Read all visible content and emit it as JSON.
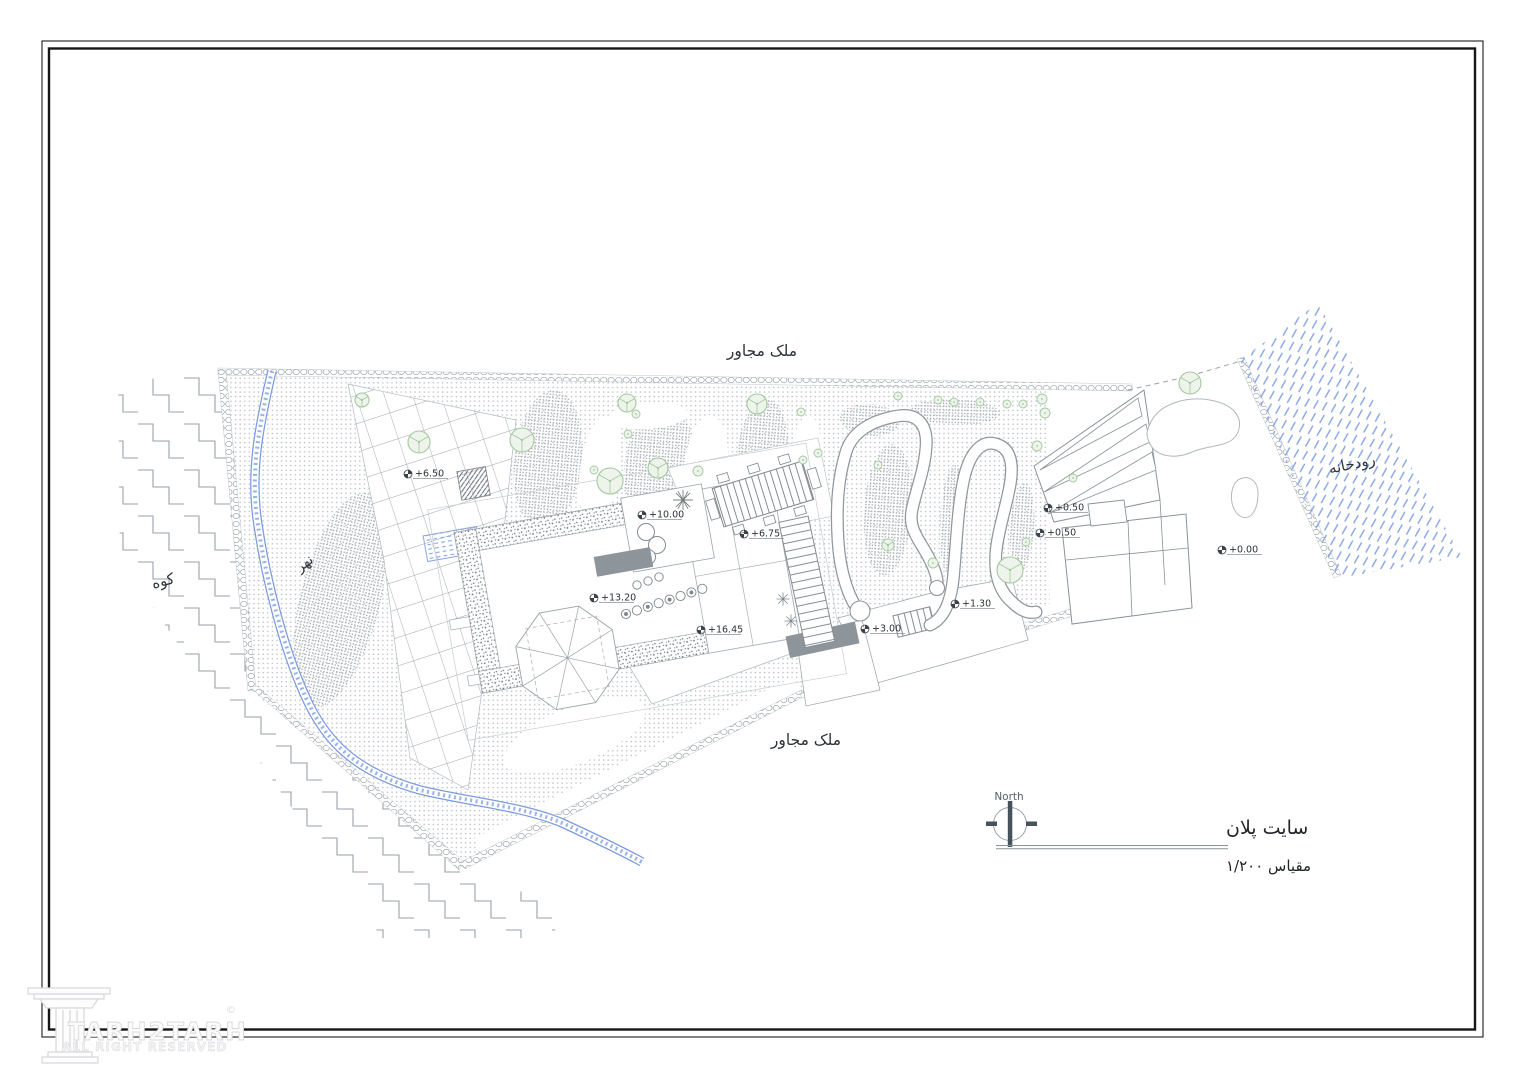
{
  "labels": {
    "adjacent_property_top": "ملک مجاور",
    "adjacent_property_bottom": "ملک مجاور",
    "mountain": "کوه",
    "creek": "نهر",
    "river": "رودخانه"
  },
  "title_block": {
    "north_label": "North",
    "title": "سایت پلان",
    "scale": "مقیاس ۱/۲۰۰"
  },
  "watermark": {
    "brand": "TARH2TARH",
    "copyright": "©",
    "rights": "ALL RIGHT RESERVED"
  },
  "elevation_markers": [
    {
      "label": "+6.50",
      "x": 404,
      "y": 470
    },
    {
      "label": "+10.00",
      "x": 638,
      "y": 511
    },
    {
      "label": "+6.75",
      "x": 740,
      "y": 530
    },
    {
      "label": "+13.20",
      "x": 590,
      "y": 594
    },
    {
      "label": "+16.45",
      "x": 697,
      "y": 626
    },
    {
      "label": "+3.00",
      "x": 861,
      "y": 625
    },
    {
      "label": "+1.30",
      "x": 951,
      "y": 600
    },
    {
      "label": "+0.50",
      "x": 1044,
      "y": 504
    },
    {
      "label": "+0.50",
      "x": 1036,
      "y": 529
    },
    {
      "label": "+0.00",
      "x": 1218,
      "y": 546
    }
  ],
  "trees": [
    {
      "x": 362,
      "y": 400,
      "r": 7
    },
    {
      "x": 419,
      "y": 442,
      "r": 11
    },
    {
      "x": 522,
      "y": 440,
      "r": 12
    },
    {
      "x": 610,
      "y": 481,
      "r": 13
    },
    {
      "x": 627,
      "y": 403,
      "r": 9
    },
    {
      "x": 636,
      "y": 414,
      "r": 4
    },
    {
      "x": 628,
      "y": 434,
      "r": 4
    },
    {
      "x": 658,
      "y": 468,
      "r": 10
    },
    {
      "x": 698,
      "y": 471,
      "r": 5
    },
    {
      "x": 757,
      "y": 404,
      "r": 10
    },
    {
      "x": 801,
      "y": 412,
      "r": 4
    },
    {
      "x": 803,
      "y": 460,
      "r": 4
    },
    {
      "x": 818,
      "y": 453,
      "r": 4
    },
    {
      "x": 594,
      "y": 470,
      "r": 4
    },
    {
      "x": 878,
      "y": 465,
      "r": 4
    },
    {
      "x": 898,
      "y": 396,
      "r": 4
    },
    {
      "x": 938,
      "y": 400,
      "r": 4
    },
    {
      "x": 954,
      "y": 402,
      "r": 4
    },
    {
      "x": 980,
      "y": 402,
      "r": 4
    },
    {
      "x": 1007,
      "y": 404,
      "r": 4
    },
    {
      "x": 1023,
      "y": 404,
      "r": 4
    },
    {
      "x": 1042,
      "y": 399,
      "r": 5
    },
    {
      "x": 1045,
      "y": 413,
      "r": 5
    },
    {
      "x": 1037,
      "y": 446,
      "r": 5
    },
    {
      "x": 888,
      "y": 545,
      "r": 6
    },
    {
      "x": 933,
      "y": 563,
      "r": 5
    },
    {
      "x": 1010,
      "y": 570,
      "r": 13
    },
    {
      "x": 1026,
      "y": 542,
      "r": 4
    },
    {
      "x": 1073,
      "y": 478,
      "r": 4
    },
    {
      "x": 1190,
      "y": 383,
      "r": 11
    }
  ],
  "colors": {
    "line_gray": "#8a9298",
    "terrain_dot": "#b6bcc2",
    "terrain_dot_dense": "#a4abb1",
    "water_blue": "#87a5e7",
    "tree_stroke": "#a3c89e",
    "tree_fill": "#eef4ec",
    "dark_fill": "#8d949a",
    "marker_dark": "#3c4348",
    "text_dark": "#2e3338",
    "frame_black": "#1c1c1c",
    "watermark_gray": "#d8d9db"
  }
}
